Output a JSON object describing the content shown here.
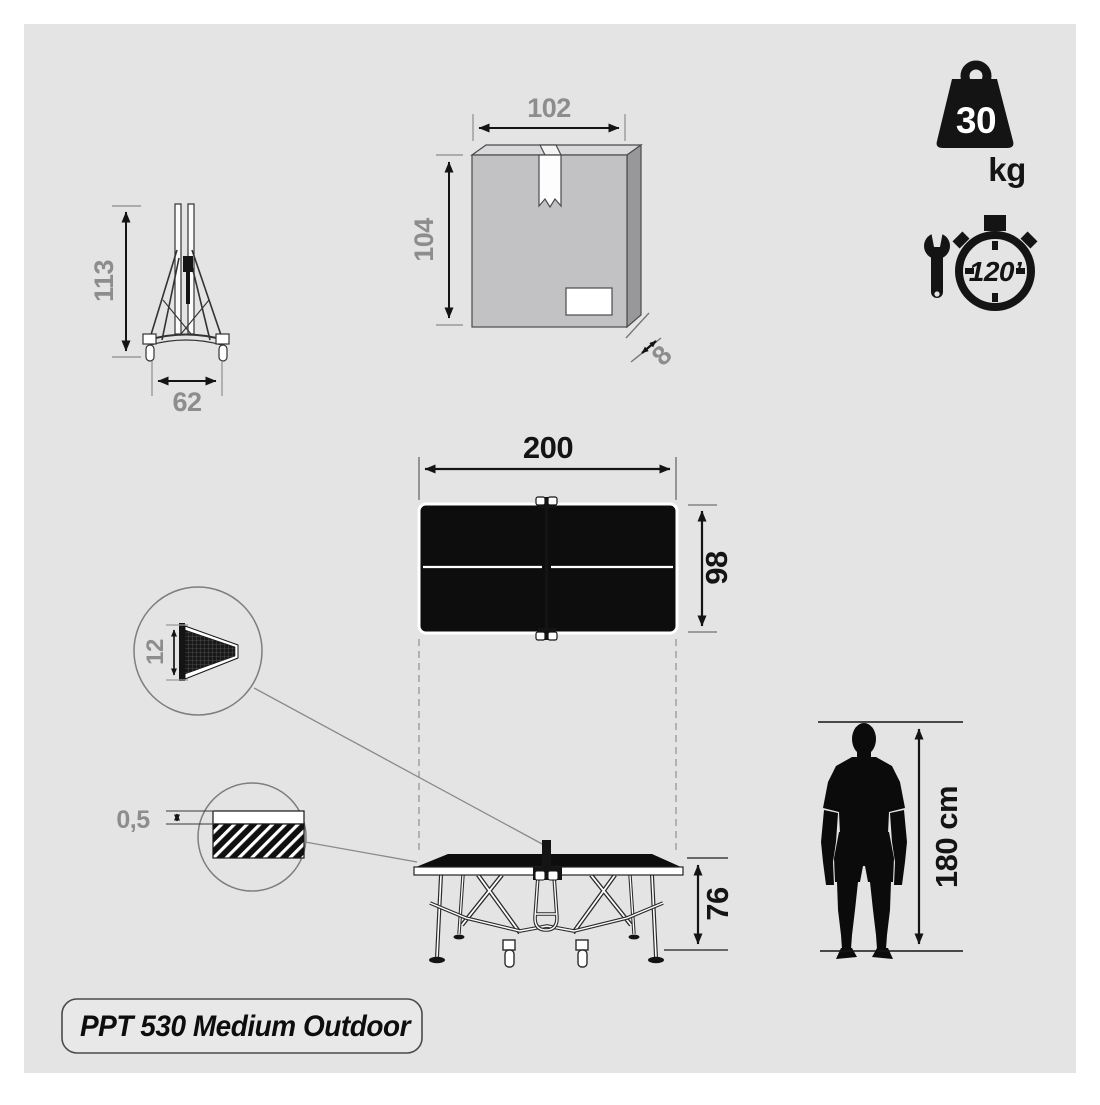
{
  "product": {
    "name": "PPT 530 Medium Outdoor"
  },
  "badges": {
    "weight": {
      "value": "30",
      "unit": "kg"
    },
    "assembly_time": {
      "value": "120’"
    }
  },
  "dimensions": {
    "folded_height": "113",
    "folded_width": "62",
    "box_width": "102",
    "box_height": "104",
    "box_depth": "8",
    "table_length": "200",
    "table_width": "98",
    "net_height": "12",
    "top_thickness": "0,5",
    "table_height": "76",
    "person_height": "180 cm"
  },
  "icons": {
    "weight": "kettlebell-weight-icon",
    "assembly": "wrench-and-stopwatch-icon"
  },
  "colors": {
    "background": "#ffffff",
    "panel": "#e4e4e4",
    "ink": "#141414",
    "muted_label": "#8d8d8d",
    "box_front": "#c2c2c4",
    "box_top": "#d9d9db",
    "box_side": "#98989a",
    "table_surface": "#0d0d0d"
  }
}
